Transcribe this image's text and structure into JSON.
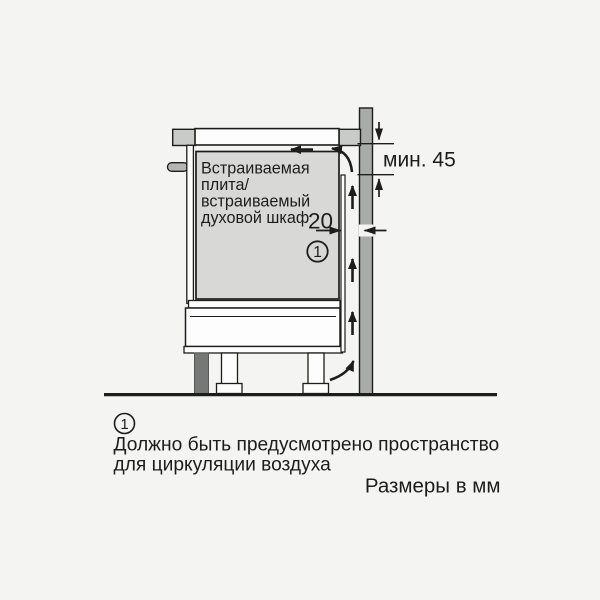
{
  "diagram": {
    "appliance_label": [
      "Встраиваемая",
      "плита/",
      "встраиваемый",
      "духовой шкаф"
    ],
    "dimensions": {
      "top_clearance": "мин. 45",
      "rear_gap": "20"
    },
    "callout_marker": "1",
    "icons": {
      "airflow_arrows": "black flow arrows showing air circulation path",
      "dimension_arrows": "dimension indicator arrows"
    }
  },
  "legend": {
    "marker": "1",
    "note_line1": "Должно быть предусмотрено пространство",
    "note_line2": "для циркуляции воздуха",
    "units_note": "Размеры в мм"
  },
  "colors": {
    "background": "#f4f4f2",
    "line": "#1d1d1b",
    "cabinet_fill": "#d8d9d7",
    "worktop_fill": "#c9cbc9",
    "wall_fill": "#a9aba9",
    "plinth_fill": "#767877",
    "handle_fill": "#b4b6b4",
    "white_fill": "#fdfdfd"
  }
}
